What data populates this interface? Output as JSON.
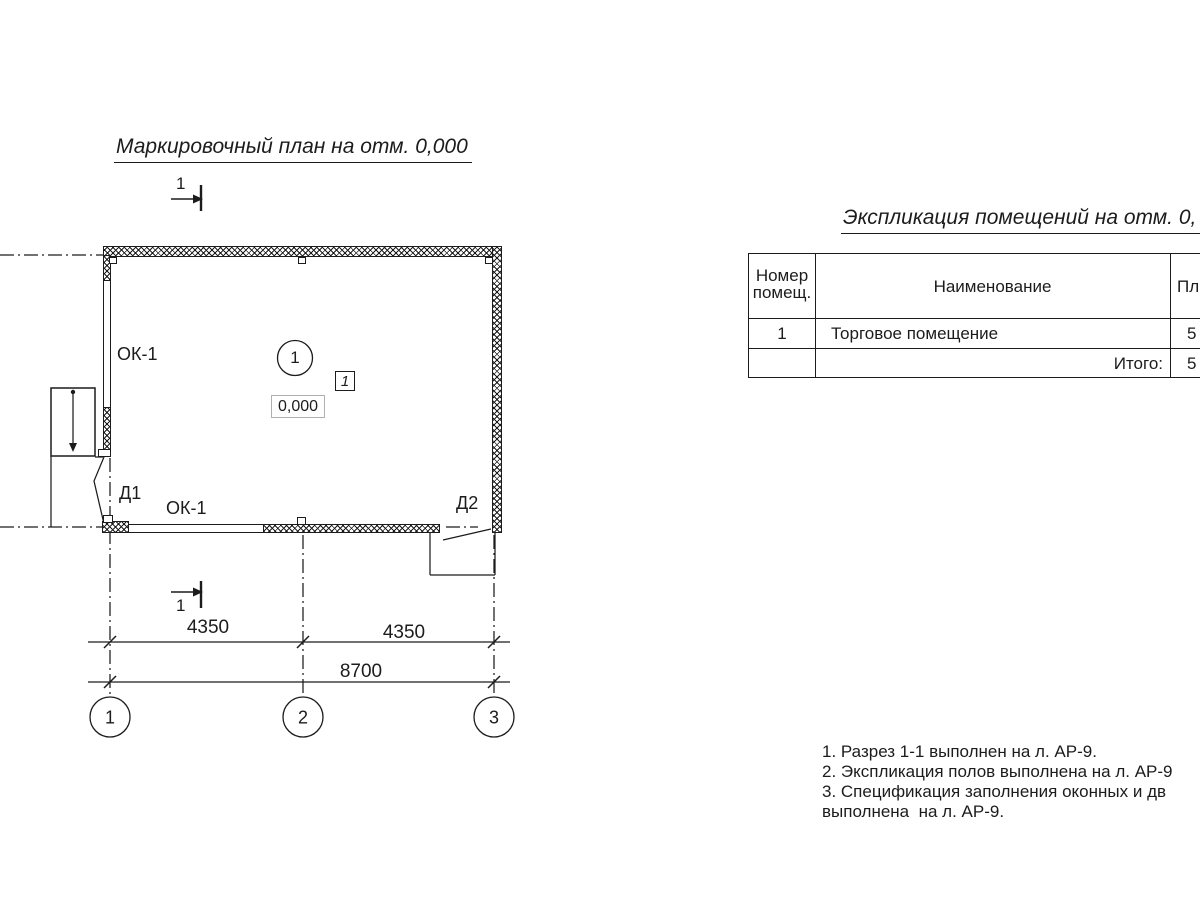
{
  "colors": {
    "line": "#1c1c1c",
    "elevation_box_border": "#b0b0b0"
  },
  "icons": {
    "section_arrow": "→",
    "stair_direction_arrow": "↓"
  },
  "plan": {
    "title": "Маркировочный план на отм. 0,000",
    "section_label_top": "1",
    "section_label_bottom": "1",
    "room_number": "1",
    "floor_type_mark": "1",
    "elevation": "0,000",
    "window_left_label": "ОК-1",
    "window_bottom_label": "ОК-1",
    "door1_label": "Д1",
    "door2_label": "Д2",
    "dim_seg1": "4350",
    "dim_seg2": "4350",
    "dim_total": "8700",
    "axis1": "1",
    "axis2": "2",
    "axis3": "3"
  },
  "table": {
    "title": "Экспликация помещений на отм. 0,",
    "col1_header": "Номер помещ.",
    "col2_header": "Наименование",
    "col3_header": "Пло",
    "row1": {
      "num": "1",
      "name": "Торговое помещение",
      "area": "5"
    },
    "total_label": "Итого:",
    "total_area": "5"
  },
  "notes": [
    "1. Разрез 1-1 выполнен на л. АР-9.",
    "2. Экспликация полов выполнена на л. АР-9",
    "3. Спецификация заполнения оконных и дв",
    "выполнена  на л. АР-9."
  ]
}
